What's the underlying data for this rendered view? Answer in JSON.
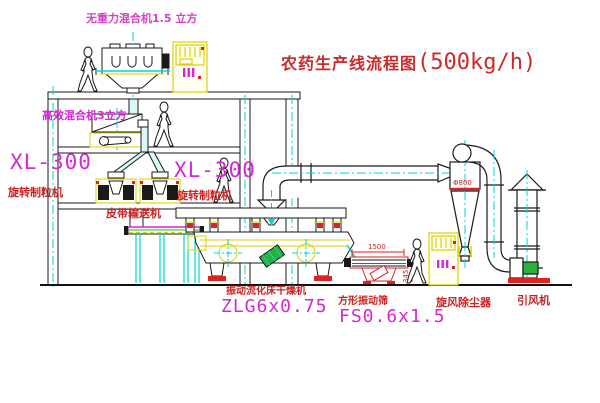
{
  "title": {
    "name": "农药生产线流程图",
    "capacity": "(500kg/h)"
  },
  "labels": {
    "top_mixer": "无重力混合机1.5 立方",
    "high_eff_mixer": "高效混合机3立方",
    "granulator_left_model": "XL-300",
    "granulator_left_name": "旋转制粒机",
    "granulator_mid_model": "XL-300",
    "granulator_mid_name": "旋转制粒机",
    "belt_conveyor": "皮带输送机",
    "dryer_name": "振动流化床干燥机",
    "dryer_model": "ZLG6x0.75",
    "sieve_name": "方形振动筛",
    "sieve_model": "FS0.6x1.5",
    "sieve_dim_width": "1500",
    "sieve_dim_height": "345",
    "cyclone_name": "旋风除尘器",
    "cyclone_dim": "Φ800",
    "fan_name": "引风机"
  },
  "colors": {
    "label_red": "#cc2222",
    "model_magenta": "#d626d6",
    "machine_yellow": "#ddd000",
    "centerline_cyan": "#00d5d5",
    "motor_green": "#2ab23a",
    "line_black": "#1a1a1a",
    "background": "#ffffff"
  }
}
